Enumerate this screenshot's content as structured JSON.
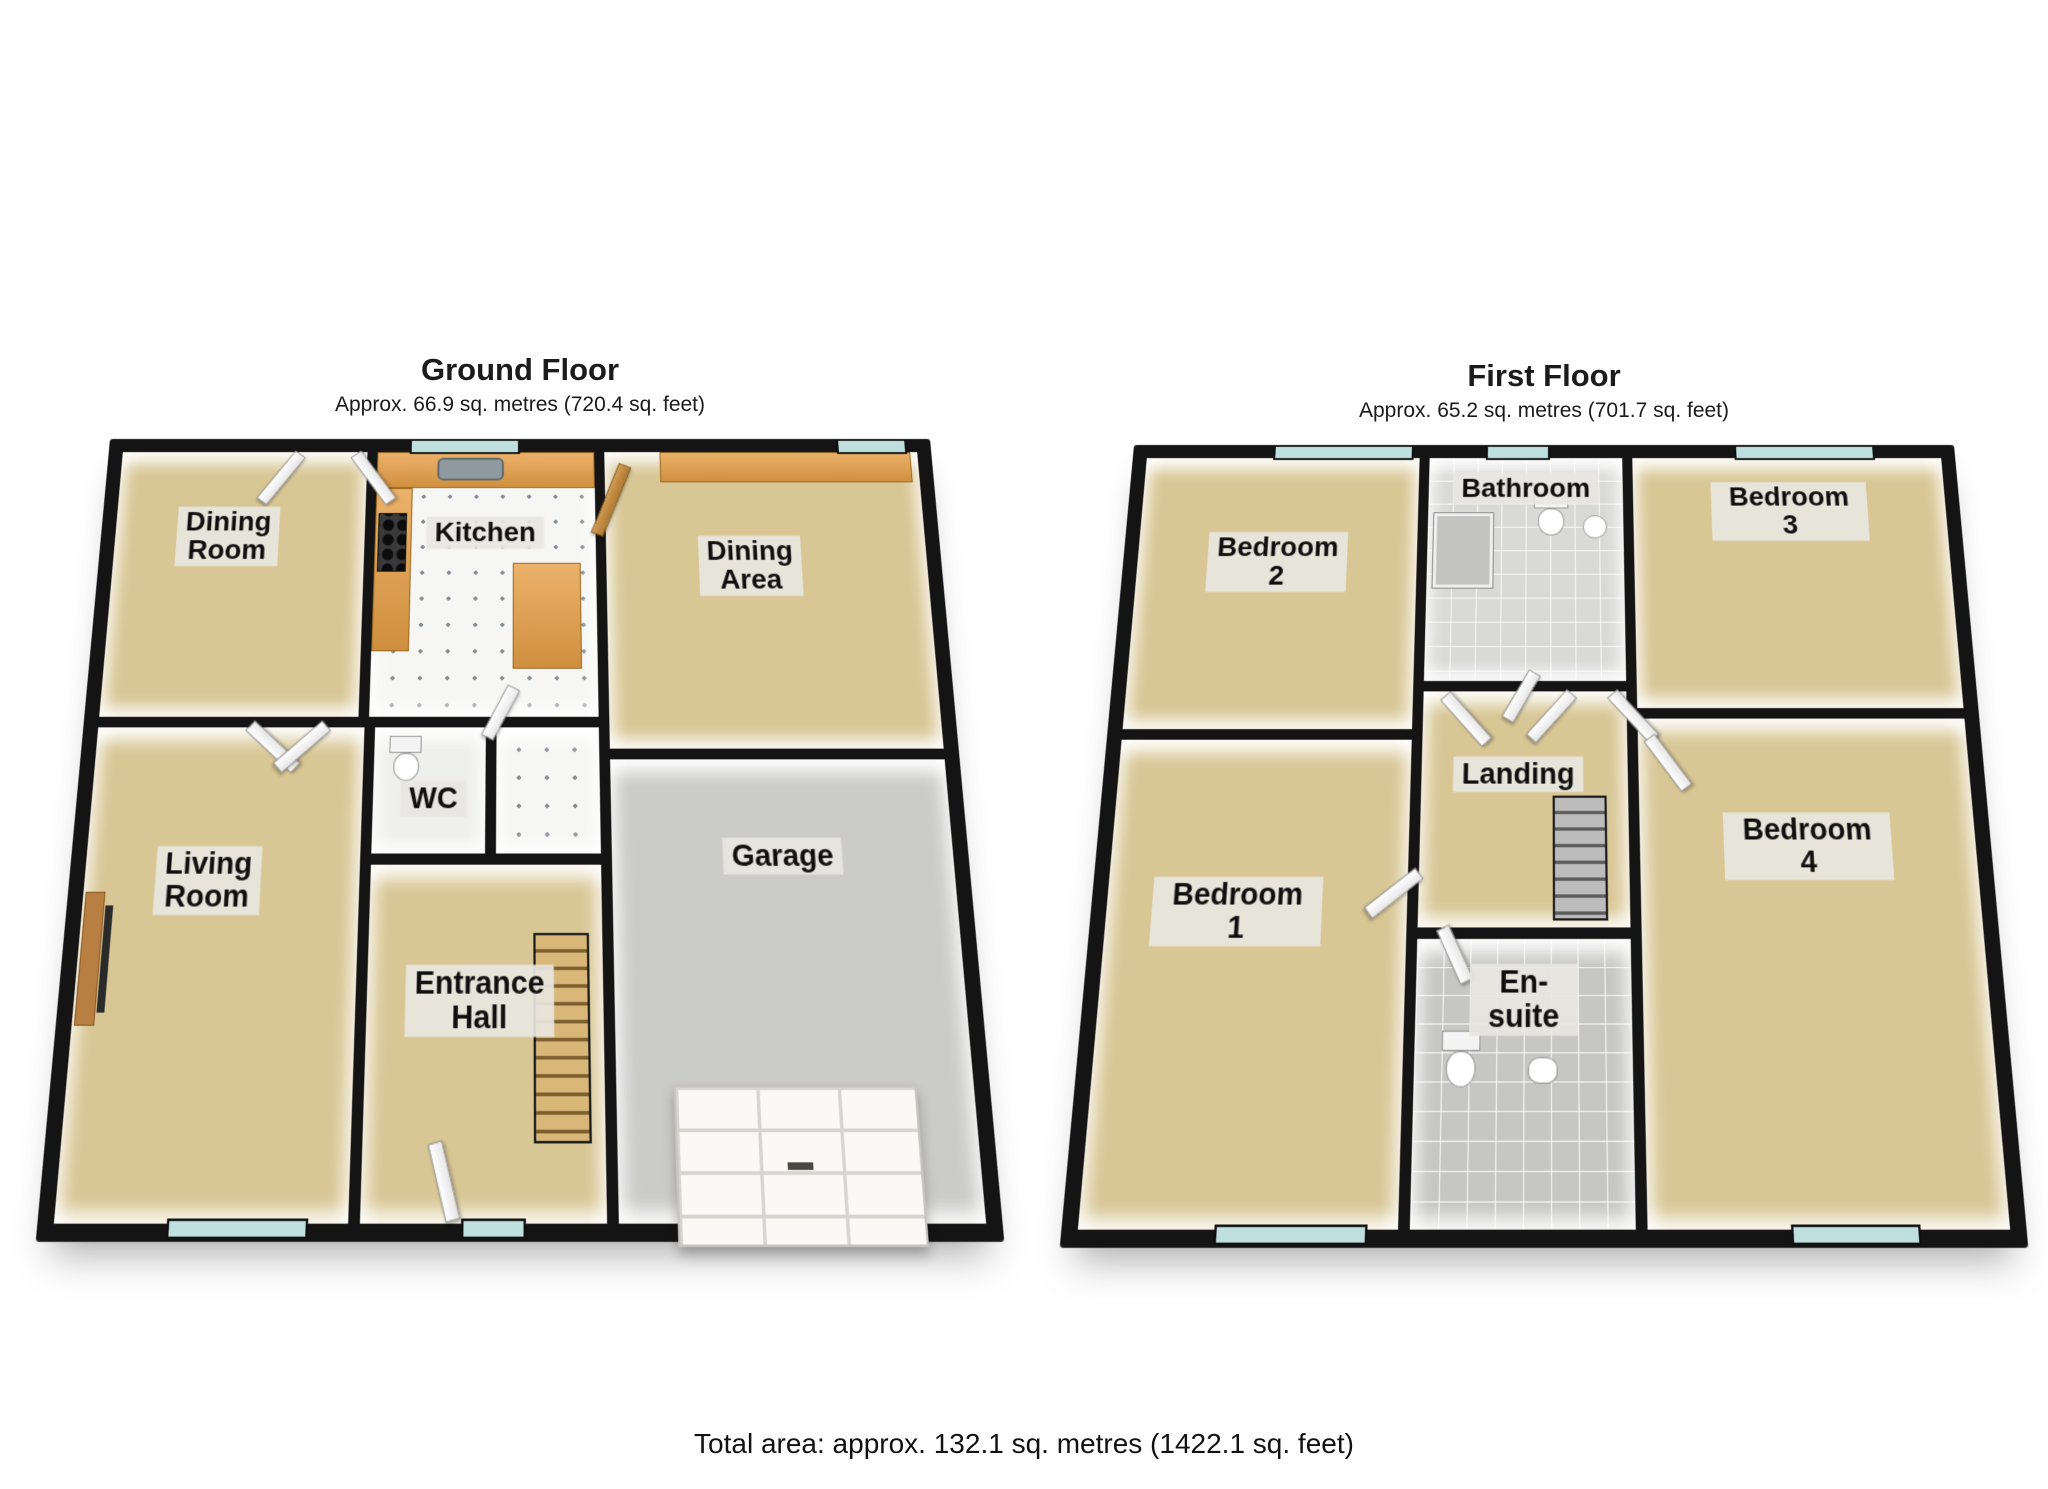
{
  "footer": {
    "total_area": "Total area: approx. 132.1 sq. metres (1422.1 sq. feet)"
  },
  "ground": {
    "title": "Ground Floor",
    "area": "Approx. 66.9 sq. metres (720.4 sq. feet)",
    "rooms": {
      "dining_room": {
        "label": "Dining\nRoom"
      },
      "kitchen": {
        "label": "Kitchen"
      },
      "dining_area": {
        "label": "Dining\nArea"
      },
      "wc": {
        "label": "WC"
      },
      "entrance_hall": {
        "label": "Entrance\nHall"
      },
      "living_room": {
        "label": "Living\nRoom"
      },
      "garage": {
        "label": "Garage"
      }
    }
  },
  "first": {
    "title": "First Floor",
    "area": "Approx. 65.2 sq. metres (701.7 sq. feet)",
    "rooms": {
      "bedroom2": {
        "label": "Bedroom 2"
      },
      "bathroom": {
        "label": "Bathroom"
      },
      "bedroom3": {
        "label": "Bedroom 3"
      },
      "landing": {
        "label": "Landing"
      },
      "bedroom4": {
        "label": "Bedroom 4"
      },
      "bedroom1": {
        "label": "Bedroom 1"
      },
      "ensuite": {
        "label": "En-suite"
      }
    }
  },
  "colors": {
    "floor_tan": "#d8c694",
    "wall_black": "#141414",
    "garage_floor": "#cbcbc9",
    "bathroom_tile": "#d9d9d7",
    "label_background": "#e8e6e0",
    "window_glass": "#bfe0df",
    "wood_counter": "#e0a55f",
    "wood_door": "#c8933f"
  }
}
